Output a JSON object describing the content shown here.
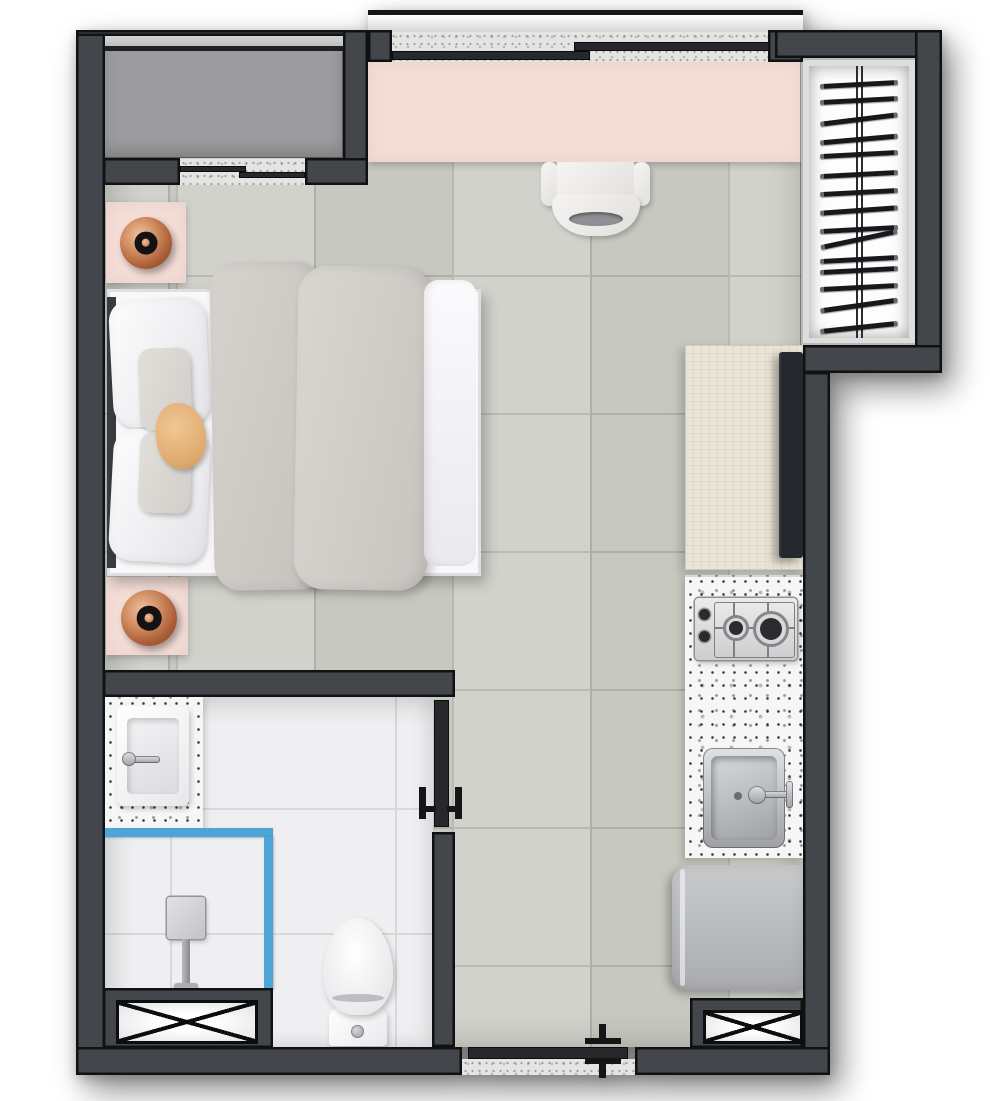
{
  "document": {
    "type": "architectural-floor-plan",
    "subject": "studio-apartment-top-down-render",
    "visible_text": "none"
  },
  "colors": {
    "wall": "#43464a",
    "wall-edge": "#101113",
    "leaf": "#26282b",
    "floor": "#cfd0c8",
    "grout": "#b5b6ae",
    "bath-floor": "#efeff1",
    "bath-grout": "#d8d8da",
    "pink": "#f3ddd6",
    "tech-gray": "#9c9c9e",
    "beige": "#e9e4d6",
    "granite": "#f6f6f6",
    "sill": "#e4e4e2",
    "blue": "#4da5d7",
    "tv": "#24272b",
    "appliance-a": "#c9cbcd",
    "appliance-b": "#a9abae"
  },
  "rooms": [
    {
      "name": "main-living-sleeping-area"
    },
    {
      "name": "bathroom"
    },
    {
      "name": "kitchen-strip"
    },
    {
      "name": "technical-balcony"
    },
    {
      "name": "drying-rack-niche"
    },
    {
      "name": "entry-corridor"
    }
  ],
  "furniture_fixtures": [
    "double-bed",
    "nightstand-top",
    "nightstand-bottom",
    "copper-table-lamp-top",
    "copper-table-lamp-bottom",
    "desk-counter",
    "desk-chair",
    "tv",
    "tv-sideboard",
    "two-burner-cooktop",
    "kitchen-counter",
    "kitchen-sink",
    "washing-machine",
    "bathroom-vanity",
    "bathroom-sink",
    "shower-enclosure",
    "shower-column",
    "toilet",
    "ventilation-shaft-left",
    "ventilation-shaft-right",
    "drying-rack"
  ],
  "openings": [
    {
      "name": "main-sliding-window",
      "wall": "top"
    },
    {
      "name": "technical-area-sliding-door",
      "wall": "top-left"
    },
    {
      "name": "entry-sliding-door",
      "wall": "bottom"
    },
    {
      "name": "bathroom-sliding-door",
      "wall": "bathroom-right"
    }
  ],
  "drying_rack": {
    "bar_count": 15,
    "bars": [
      {
        "top": 24,
        "rot": -3
      },
      {
        "top": 40,
        "rot": -3
      },
      {
        "top": 59,
        "rot": -7
      },
      {
        "top": 79,
        "rot": -5
      },
      {
        "top": 94,
        "rot": -3
      },
      {
        "top": 114,
        "rot": -3
      },
      {
        "top": 132,
        "rot": -3
      },
      {
        "top": 150,
        "rot": -4
      },
      {
        "top": 169,
        "rot": -3
      },
      {
        "top": 179,
        "rot": -12
      },
      {
        "top": 199,
        "rot": -3
      },
      {
        "top": 210,
        "rot": -3
      },
      {
        "top": 227,
        "rot": -3
      },
      {
        "top": 245,
        "rot": -8
      },
      {
        "top": 267,
        "rot": -6
      }
    ]
  }
}
